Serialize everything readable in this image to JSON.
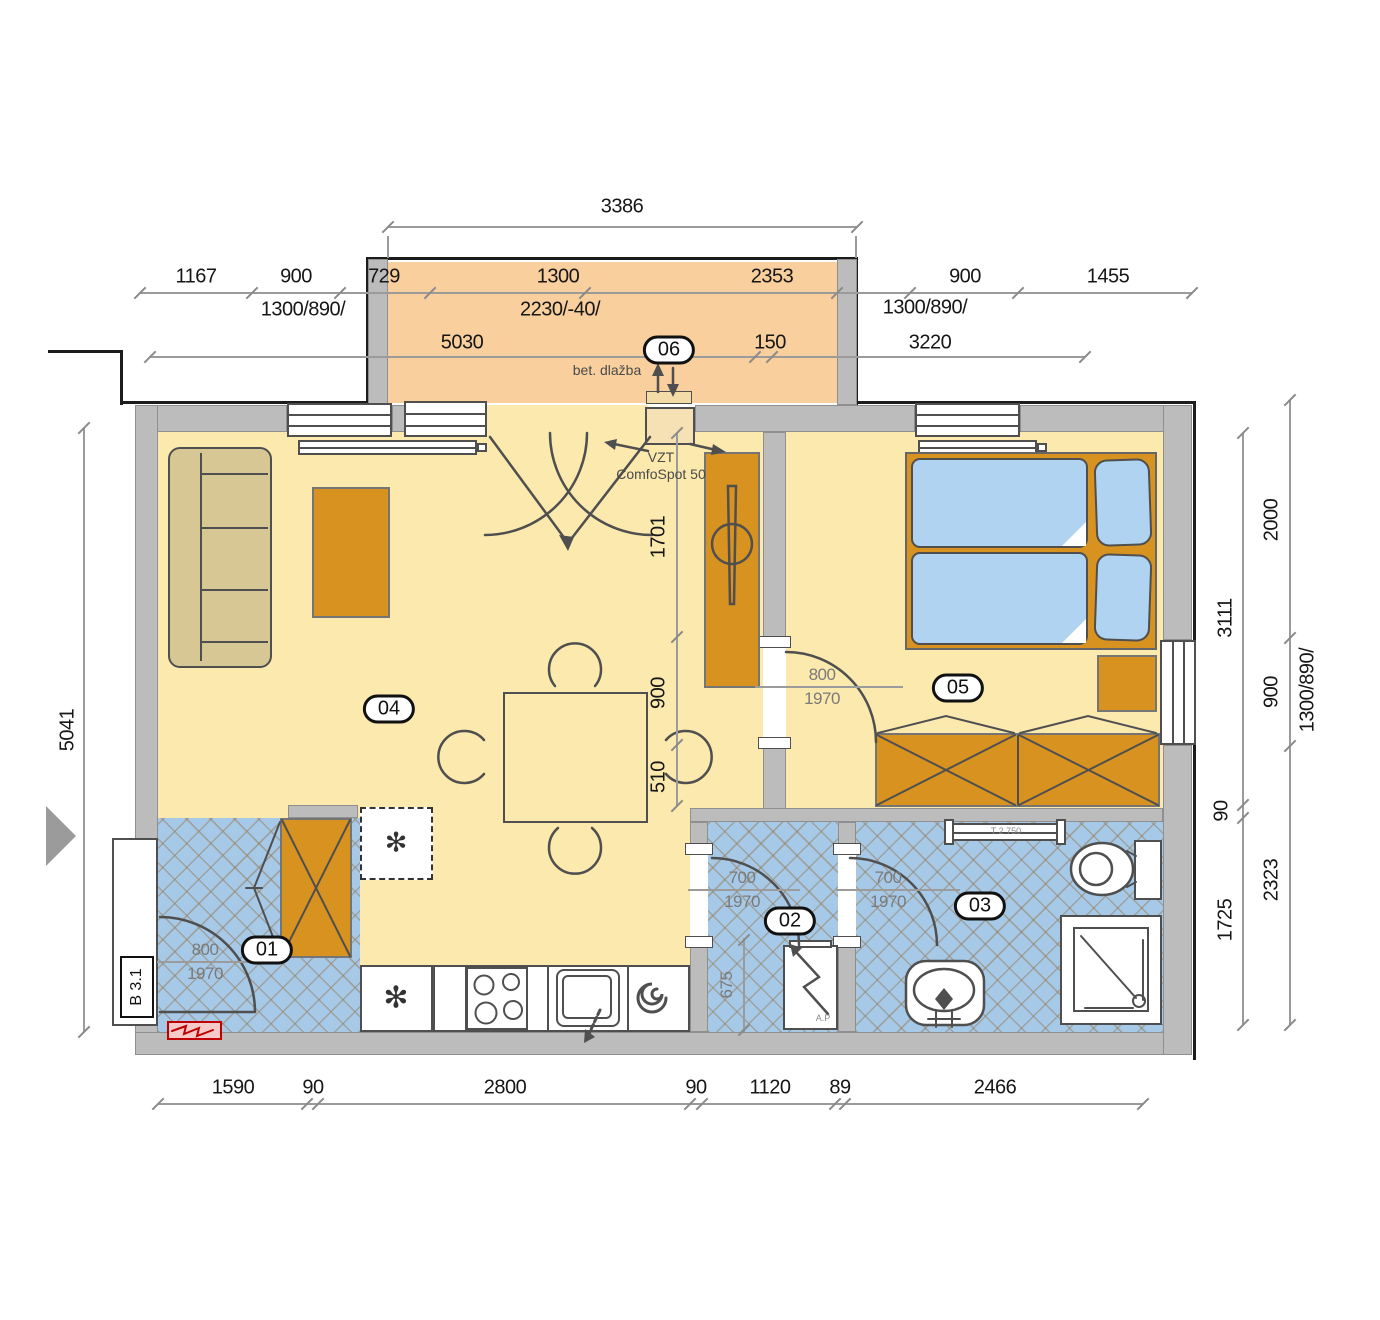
{
  "badges": [
    "01",
    "02",
    "03",
    "04",
    "05",
    "06"
  ],
  "icons": {
    "freezer": "✻",
    "fridge": "✻"
  },
  "annotations": {
    "balcony_floor": "bet. dlažba",
    "vzt_line1": "VZT",
    "vzt_line2": "ComfoSpot 50",
    "entry_door_ref": "B 3.1",
    "towel_radiator_ref": "T 2 750",
    "heater_ref": "A.P"
  },
  "dimensions": {
    "top_overall": "3386",
    "row2": [
      "1167",
      "900",
      "729",
      "1300",
      "2353",
      "900",
      "1455"
    ],
    "row2_specs": [
      "1300/890/",
      "2230/-40/",
      "1300/890/"
    ],
    "row3": [
      "5030",
      "150",
      "3220"
    ],
    "left_overall": "5041",
    "right_inner": [
      "3111",
      "90",
      "1725"
    ],
    "right_outer": [
      "2000",
      "900",
      "2323"
    ],
    "right_window_spec": "1300/890/",
    "bottom": [
      "1590",
      "90",
      "2800",
      "90",
      "1120",
      "89",
      "2466"
    ],
    "living_vertical": [
      "1701",
      "900",
      "510"
    ],
    "room02_width": "675",
    "doors": {
      "entry": {
        "width": "800",
        "height": "1970"
      },
      "bedroom": {
        "width": "800",
        "height": "1970"
      },
      "wc": {
        "width": "700",
        "height": "1970"
      },
      "bath": {
        "width": "700",
        "height": "1970"
      }
    }
  }
}
